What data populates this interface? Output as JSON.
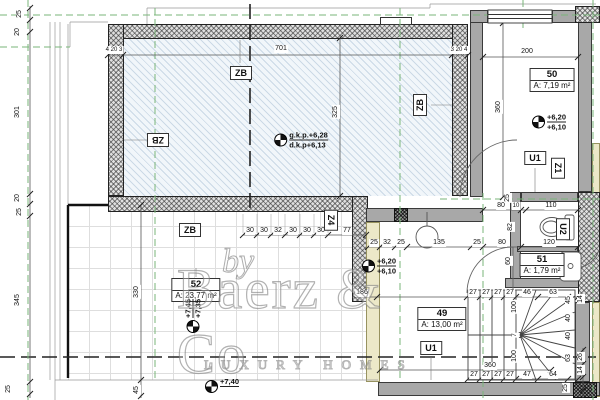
{
  "watermark": {
    "by": "by",
    "brand": "Baerz & Co",
    "tagline": "LUXURY HOMES"
  },
  "rooms": [
    {
      "num": "50",
      "area": "A: 7,19 m²",
      "x": 552,
      "y": 80,
      "r": 0
    },
    {
      "num": "52",
      "area": "A: 23,77 m²",
      "x": 196,
      "y": 290,
      "r": 0
    },
    {
      "num": "49",
      "area": "A: 13,00 m²",
      "x": 442,
      "y": 319,
      "r": 0
    },
    {
      "num": "51",
      "area": "A: 1,79 m²",
      "x": 542,
      "y": 265,
      "r": 0
    }
  ],
  "zone_tags": [
    {
      "t": "ZB",
      "x": 241,
      "y": 73,
      "r": 0
    },
    {
      "t": "ZB",
      "x": 158,
      "y": 140,
      "r": 180
    },
    {
      "t": "ZB",
      "x": 420,
      "y": 105,
      "r": -90
    },
    {
      "t": "ZB",
      "x": 190,
      "y": 230,
      "r": 0
    },
    {
      "t": "Z4",
      "x": 331,
      "y": 220,
      "r": 90
    },
    {
      "t": "U1",
      "x": 535,
      "y": 158,
      "r": 0
    },
    {
      "t": "Z1",
      "x": 558,
      "y": 168,
      "r": 90
    },
    {
      "t": "U2",
      "x": 563,
      "y": 229,
      "r": 90
    },
    {
      "t": "U1",
      "x": 431,
      "y": 348,
      "r": 0
    }
  ],
  "levels": [
    {
      "l1": "g.k.p.+6,28",
      "l2": "d.k.p+6,13",
      "x": 301,
      "y": 140,
      "r": 0
    },
    {
      "l1": "+6,20",
      "l2": "+6,10",
      "x": 549,
      "y": 122,
      "r": 0
    },
    {
      "l1": "+6,20",
      "l2": "+6,10",
      "x": 379,
      "y": 266,
      "r": 0
    },
    {
      "l1": "+7,45",
      "l2": "+7,35",
      "x": 193,
      "y": 316,
      "r": -90
    },
    {
      "l1": "+7,40",
      "l2": "",
      "x": 222,
      "y": 386,
      "r": 0
    }
  ],
  "dims": [
    {
      "t": "701",
      "x": 281,
      "y": 49
    },
    {
      "t": "4 20 3",
      "x": 114,
      "y": 50,
      "s": 1
    },
    {
      "t": "3 20 4",
      "x": 459,
      "y": 50,
      "s": 1
    },
    {
      "t": "200",
      "x": 527,
      "y": 52
    },
    {
      "t": "30",
      "x": 250,
      "y": 231
    },
    {
      "t": "30",
      "x": 264,
      "y": 231
    },
    {
      "t": "32",
      "x": 278,
      "y": 231
    },
    {
      "t": "30",
      "x": 293,
      "y": 231
    },
    {
      "t": "30",
      "x": 307,
      "y": 231
    },
    {
      "t": "30",
      "x": 321,
      "y": 231
    },
    {
      "t": "77",
      "x": 347,
      "y": 231
    },
    {
      "t": "80",
      "x": 501,
      "y": 206
    },
    {
      "t": "10",
      "x": 516,
      "y": 206,
      "s": 1
    },
    {
      "t": "110",
      "x": 551,
      "y": 206
    },
    {
      "t": "25",
      "x": 374,
      "y": 243
    },
    {
      "t": "32",
      "x": 387,
      "y": 243
    },
    {
      "t": "25",
      "x": 401,
      "y": 243
    },
    {
      "t": "135",
      "x": 439,
      "y": 243
    },
    {
      "t": "25",
      "x": 477,
      "y": 243
    },
    {
      "t": "80",
      "x": 502,
      "y": 243
    },
    {
      "t": "120",
      "x": 549,
      "y": 243
    },
    {
      "t": "186",
      "x": 362,
      "y": 293
    },
    {
      "t": "27",
      "x": 473,
      "y": 293
    },
    {
      "t": "27",
      "x": 486,
      "y": 293
    },
    {
      "t": "27",
      "x": 498,
      "y": 293
    },
    {
      "t": "27",
      "x": 510,
      "y": 293
    },
    {
      "t": "46",
      "x": 527,
      "y": 293
    },
    {
      "t": "63",
      "x": 553,
      "y": 293
    },
    {
      "t": "360",
      "x": 490,
      "y": 366
    },
    {
      "t": "27",
      "x": 474,
      "y": 375
    },
    {
      "t": "27",
      "x": 486,
      "y": 375
    },
    {
      "t": "27",
      "x": 498,
      "y": 375
    },
    {
      "t": "27",
      "x": 510,
      "y": 375
    },
    {
      "t": "47",
      "x": 527,
      "y": 375
    },
    {
      "t": "64",
      "x": 553,
      "y": 375
    },
    {
      "t": "25",
      "x": 20,
      "y": 14,
      "r": -90
    },
    {
      "t": "20",
      "x": 18,
      "y": 32,
      "r": -90
    },
    {
      "t": "301",
      "x": 18,
      "y": 112,
      "r": -90
    },
    {
      "t": "20",
      "x": 18,
      "y": 198,
      "r": -90
    },
    {
      "t": "25",
      "x": 20,
      "y": 212,
      "r": -90
    },
    {
      "t": "345",
      "x": 18,
      "y": 300,
      "r": -90
    },
    {
      "t": "25",
      "x": 9,
      "y": 389,
      "r": -90
    },
    {
      "t": "325",
      "x": 336,
      "y": 112,
      "r": -90
    },
    {
      "t": "360",
      "x": 499,
      "y": 107,
      "r": -90
    },
    {
      "t": "330",
      "x": 137,
      "y": 292,
      "r": -90
    },
    {
      "t": "45",
      "x": 137,
      "y": 390,
      "r": -90
    },
    {
      "t": "25",
      "x": 508,
      "y": 198,
      "r": -90
    },
    {
      "t": "82",
      "x": 511,
      "y": 227,
      "r": -90
    },
    {
      "t": "60",
      "x": 509,
      "y": 261,
      "r": -90
    },
    {
      "t": "100",
      "x": 515,
      "y": 307,
      "r": -90
    },
    {
      "t": "7",
      "x": 515,
      "y": 335,
      "r": -90,
      "s": 1
    },
    {
      "t": "100",
      "x": 515,
      "y": 356,
      "r": -90
    },
    {
      "t": "45",
      "x": 569,
      "y": 300,
      "r": -90
    },
    {
      "t": "40",
      "x": 569,
      "y": 318,
      "r": -90
    },
    {
      "t": "40",
      "x": 569,
      "y": 336,
      "r": -90
    },
    {
      "t": "63",
      "x": 569,
      "y": 358,
      "r": -90
    },
    {
      "t": "14",
      "x": 581,
      "y": 299,
      "r": -90
    },
    {
      "t": "26",
      "x": 581,
      "y": 357,
      "r": -90
    },
    {
      "t": "14",
      "x": 581,
      "y": 370,
      "r": -90
    },
    {
      "t": "25",
      "x": 566,
      "y": 388,
      "r": -90
    }
  ]
}
